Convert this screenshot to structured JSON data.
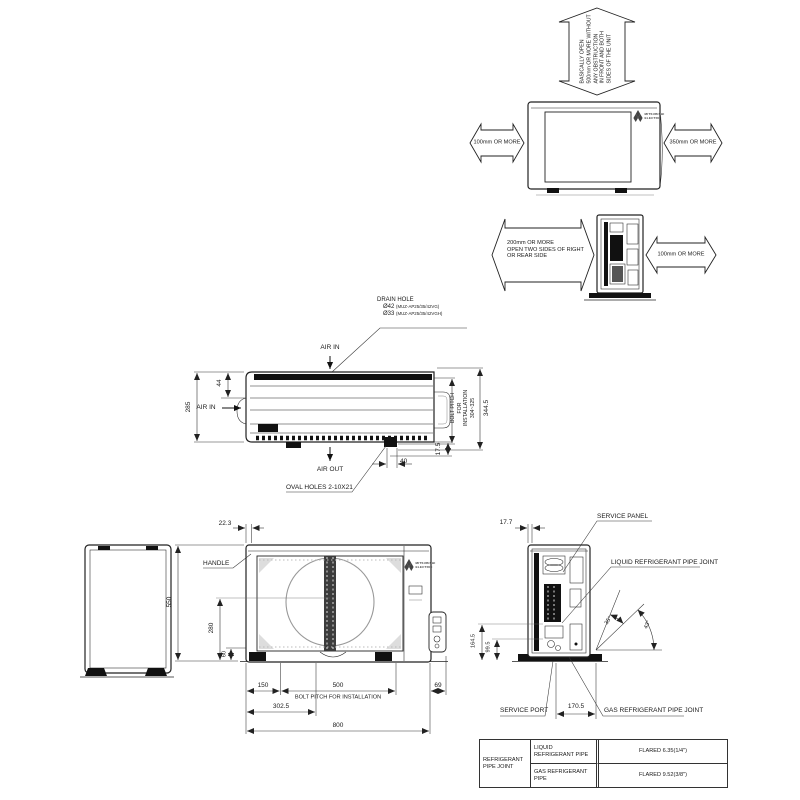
{
  "brand": {
    "line1": "MITSUBISHI",
    "line2": "ELECTRIC"
  },
  "clearance_front_view": {
    "top_arrow": {
      "lines": [
        "BASICALLY OPEN",
        "500mm OR MORE WITHOUT",
        "ANY OBSTRUCTION",
        "IN FRONT AND BOTH",
        "SIDES OF THE UNIT"
      ]
    },
    "left_arrow": "100mm OR MORE",
    "right_arrow": "350mm OR MORE"
  },
  "clearance_side_view": {
    "left_arrow": {
      "lines": [
        "200mm OR MORE",
        "OPEN TWO SIDES OF RIGHT",
        "OR REAR SIDE"
      ]
    },
    "right_arrow": "100mm OR MORE"
  },
  "top_view": {
    "drain_hole_label": "DRAIN HOLE",
    "drain_hole_dia1": "Ø42",
    "drain_hole_model1": "(MUZ-AP25/35/42VG)",
    "drain_hole_dia2": "Ø33",
    "drain_hole_model2": "(MUZ-AP25/35/42VGH)",
    "air_in_top": "AIR IN",
    "air_in_left": "AIR IN",
    "air_out": "AIR OUT",
    "oval_holes": "OVAL HOLES 2-10X21",
    "dim_depth": "285",
    "dim_back_offset": "44",
    "bolt_pitch_label": "BOLT PITCH FOR INSTALLATION",
    "bolt_pitch_range": "304~325",
    "dim_overall_depth": "344.5",
    "dim_foot_offset": "40",
    "dim_foot_inset": "17.5"
  },
  "front_view": {
    "handle_label": "HANDLE",
    "dim_handle_offset": "22.3",
    "dim_height": "550",
    "dim_fan_center": "280",
    "dim_base_height": "60",
    "dim_left_foot": "150",
    "dim_bolt_pitch": "500",
    "bolt_pitch_label": "BOLT PITCH FOR INSTALLATION",
    "dim_drain_pos": "302.5",
    "dim_width": "800",
    "dim_right_offset": "69"
  },
  "piping_side_view": {
    "dim_top_offset": "17.7",
    "service_panel_label": "SERVICE PANEL",
    "liquid_joint_label": "LIQUID REFRIGERANT PIPE JOINT",
    "gas_joint_label": "GAS REFRIGERANT PIPE JOINT",
    "service_port_label": "SERVICE PORT",
    "angle_inner": "35°",
    "angle_outer": "43°",
    "dim_liquid_height": "164.5",
    "dim_gas_height": "99.5",
    "dim_joint_offset": "170.5"
  },
  "spec_table": {
    "row_group": "REFRIGERANT PIPE JOINT",
    "rows": [
      {
        "label": "LIQUID REFRIGERANT PIPE",
        "value": "FLARED 6.35(1/4\")"
      },
      {
        "label": "GAS REFRIGERANT PIPE",
        "value": "FLARED 9.52(3/8\")"
      }
    ]
  }
}
